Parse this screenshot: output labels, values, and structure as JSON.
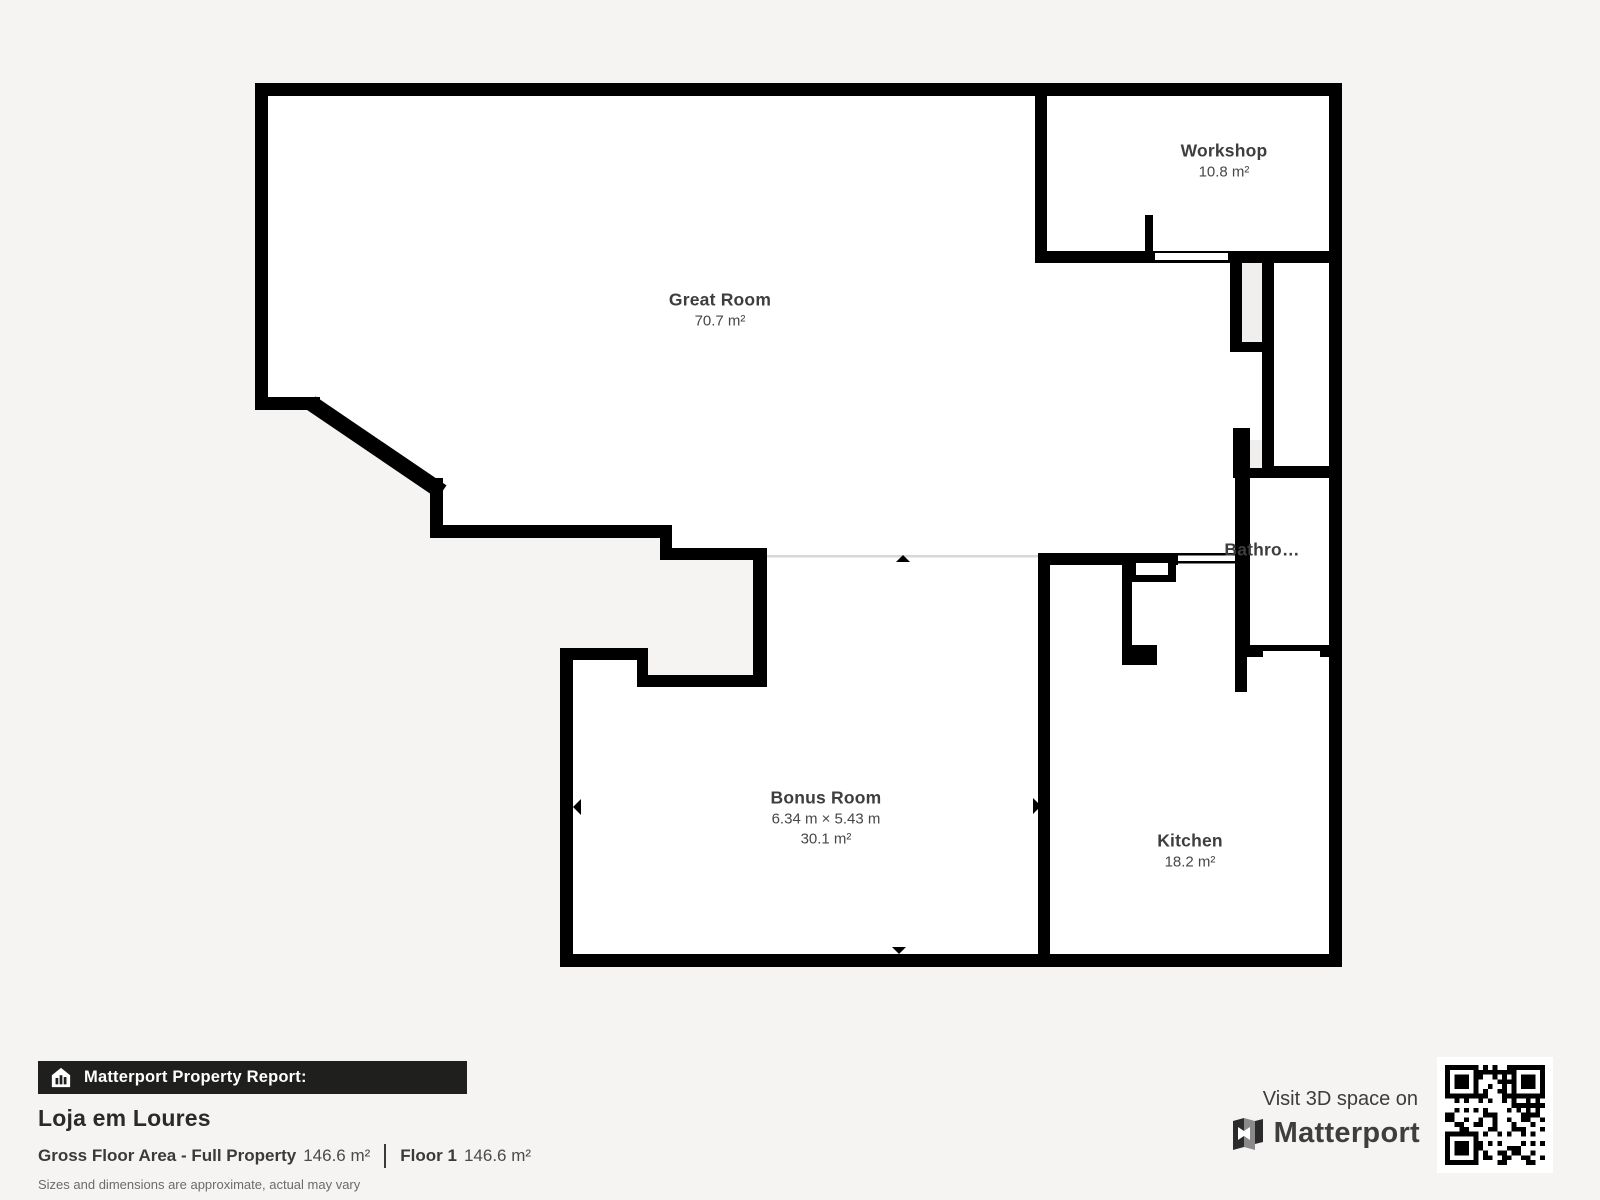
{
  "floor_plan": {
    "rooms": [
      {
        "name": "Great Room",
        "dimensions": "",
        "area": "70.7 m²"
      },
      {
        "name": "Workshop",
        "dimensions": "",
        "area": "10.8 m²"
      },
      {
        "name": "Bathro…",
        "dimensions": "",
        "area": ""
      },
      {
        "name": "Bonus Room",
        "dimensions": "6.34 m × 5.43 m",
        "area": "30.1 m²"
      },
      {
        "name": "Kitchen",
        "dimensions": "",
        "area": "18.2 m²"
      }
    ],
    "colors": {
      "background": "#f5f4f2",
      "room_fill": "#ffffff",
      "wall": "#000000",
      "shaft_fill": "#f0efed",
      "separator_line": "#d9d8d6",
      "label_text": "#3e3e3e"
    }
  },
  "report": {
    "badge_label": "Matterport Property Report:",
    "property_name": "Loja em Loures",
    "gross_floor_area_label": "Gross Floor Area - Full Property",
    "gross_floor_area_value": "146.6 m²",
    "floor_label": "Floor 1",
    "floor_value": "146.6 m²",
    "disclaimer": "Sizes and dimensions are approximate, actual may vary"
  },
  "promo": {
    "visit_text": "Visit 3D space on",
    "brand": "Matterport"
  }
}
